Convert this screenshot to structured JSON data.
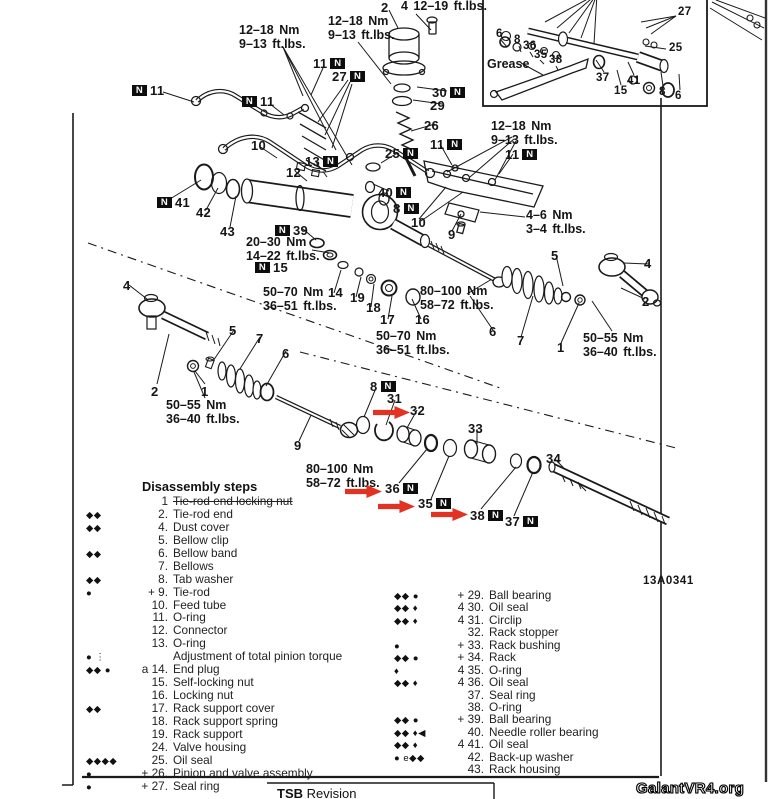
{
  "page": {
    "diagram_code": "13A0341",
    "watermark": "GalantVR4.org",
    "footer": {
      "bold": "TSB",
      "rest": "Revision"
    },
    "grease_label": "Grease",
    "n_badge": "N"
  },
  "diagram": {
    "torque_labels": [
      {
        "x": 239,
        "y": 24,
        "lines": [
          "12–18 Nm",
          "9–13 ft.lbs."
        ]
      },
      {
        "x": 328,
        "y": 15,
        "lines": [
          "12–18 Nm",
          "9–13 ft.lbs."
        ]
      },
      {
        "x": 401,
        "y": 0,
        "lines": [
          "4 12–19 ft.lbs."
        ]
      },
      {
        "x": 491,
        "y": 120,
        "lines": [
          "12–18 Nm",
          "9–13 ft.lbs."
        ]
      },
      {
        "x": 246,
        "y": 236,
        "lines": [
          "20–30 Nm",
          "14–22 ft.lbs."
        ]
      },
      {
        "x": 263,
        "y": 286,
        "lines": [
          "50–70 Nm",
          "36–51 ft.lbs."
        ]
      },
      {
        "x": 420,
        "y": 285,
        "lines": [
          "80–100 Nm",
          "58–72 ft.lbs."
        ]
      },
      {
        "x": 526,
        "y": 209,
        "lines": [
          "4–6 Nm",
          "3–4 ft.lbs."
        ]
      },
      {
        "x": 583,
        "y": 332,
        "lines": [
          "50–55 Nm",
          "36–40 ft.lbs."
        ]
      },
      {
        "x": 376,
        "y": 330,
        "lines": [
          "50–70 Nm",
          "36–51 ft.lbs."
        ]
      },
      {
        "x": 166,
        "y": 399,
        "lines": [
          "50–55 Nm",
          "36–40 ft.lbs."
        ]
      },
      {
        "x": 306,
        "y": 463,
        "lines": [
          "80–100 Nm",
          "58–72 ft.lbs."
        ]
      }
    ],
    "part_labels": [
      {
        "t": "2",
        "x": 381,
        "y": 0
      },
      {
        "t": "11",
        "b": "a",
        "x": 313,
        "y": 56
      },
      {
        "t": "27",
        "b": "a",
        "x": 332,
        "y": 69
      },
      {
        "t": "11",
        "b": "b",
        "x": 132,
        "y": 83
      },
      {
        "t": "11",
        "b": "b",
        "x": 242,
        "y": 94
      },
      {
        "t": "30",
        "b": "a",
        "x": 432,
        "y": 85
      },
      {
        "t": "29",
        "x": 430,
        "y": 98
      },
      {
        "t": "26",
        "x": 424,
        "y": 118
      },
      {
        "t": "11",
        "b": "a",
        "x": 430,
        "y": 137
      },
      {
        "t": "25",
        "b": "a",
        "x": 385,
        "y": 146
      },
      {
        "t": "11",
        "b": "a",
        "x": 505,
        "y": 147
      },
      {
        "t": "10",
        "x": 251,
        "y": 138
      },
      {
        "t": "13",
        "b": "a",
        "x": 305,
        "y": 154
      },
      {
        "t": "12",
        "x": 286,
        "y": 165
      },
      {
        "t": "40",
        "b": "a",
        "x": 378,
        "y": 185
      },
      {
        "t": "8",
        "b": "a",
        "x": 393,
        "y": 201
      },
      {
        "t": "10",
        "x": 411,
        "y": 215
      },
      {
        "t": "9",
        "x": 448,
        "y": 227
      },
      {
        "t": "41",
        "b": "b",
        "x": 157,
        "y": 195
      },
      {
        "t": "42",
        "x": 196,
        "y": 205
      },
      {
        "t": "43",
        "x": 220,
        "y": 224
      },
      {
        "t": "39",
        "b": "b",
        "x": 275,
        "y": 223
      },
      {
        "t": "15",
        "b": "b",
        "x": 255,
        "y": 260
      },
      {
        "t": "14",
        "x": 328,
        "y": 285
      },
      {
        "t": "19",
        "x": 350,
        "y": 290
      },
      {
        "t": "18",
        "x": 366,
        "y": 300
      },
      {
        "t": "17",
        "x": 380,
        "y": 312
      },
      {
        "t": "16",
        "x": 415,
        "y": 312
      },
      {
        "t": "5",
        "x": 551,
        "y": 248
      },
      {
        "t": "4",
        "x": 644,
        "y": 256
      },
      {
        "t": "2",
        "x": 642,
        "y": 294
      },
      {
        "t": "1",
        "x": 557,
        "y": 340
      },
      {
        "t": "7",
        "x": 517,
        "y": 333
      },
      {
        "t": "6",
        "x": 489,
        "y": 324
      },
      {
        "t": "4",
        "x": 123,
        "y": 278
      },
      {
        "t": "5",
        "x": 229,
        "y": 323
      },
      {
        "t": "7",
        "x": 256,
        "y": 331
      },
      {
        "t": "6",
        "x": 282,
        "y": 346
      },
      {
        "t": "2",
        "x": 151,
        "y": 384
      },
      {
        "t": "1",
        "x": 201,
        "y": 384
      },
      {
        "t": "9",
        "x": 294,
        "y": 438
      },
      {
        "t": "8",
        "b": "a",
        "x": 370,
        "y": 379
      },
      {
        "t": "31",
        "x": 387,
        "y": 391
      },
      {
        "t": "32",
        "x": 410,
        "y": 403
      },
      {
        "t": "33",
        "x": 468,
        "y": 421
      },
      {
        "t": "34",
        "x": 546,
        "y": 451
      },
      {
        "t": "36",
        "b": "a",
        "x": 385,
        "y": 481
      },
      {
        "t": "35",
        "b": "a",
        "x": 418,
        "y": 496
      },
      {
        "t": "38",
        "b": "a",
        "x": 470,
        "y": 508
      },
      {
        "t": "37",
        "b": "a",
        "x": 505,
        "y": 514
      },
      {
        "t": "27",
        "x": 678,
        "y": 6,
        "fs": "s"
      },
      {
        "t": "6",
        "x": 496,
        "y": 28,
        "fs": "s"
      },
      {
        "t": "8",
        "x": 514,
        "y": 34,
        "fs": "s"
      },
      {
        "t": "36",
        "x": 523,
        "y": 40,
        "fs": "s"
      },
      {
        "t": "35",
        "x": 534,
        "y": 49,
        "fs": "s"
      },
      {
        "t": "38",
        "x": 549,
        "y": 54,
        "fs": "s"
      },
      {
        "t": "25",
        "x": 669,
        "y": 42,
        "fs": "s"
      },
      {
        "t": "37",
        "x": 596,
        "y": 72,
        "fs": "s"
      },
      {
        "t": "41",
        "x": 627,
        "y": 75,
        "fs": "s"
      },
      {
        "t": "15",
        "x": 614,
        "y": 85,
        "fs": "s"
      },
      {
        "t": "8",
        "x": 659,
        "y": 86,
        "fs": "s"
      },
      {
        "t": "6",
        "x": 675,
        "y": 90,
        "fs": "s"
      }
    ],
    "red_arrows": [
      {
        "x": 373,
        "y": 406
      },
      {
        "x": 345,
        "y": 485
      },
      {
        "x": 378,
        "y": 500
      },
      {
        "x": 431,
        "y": 508
      }
    ],
    "grease_pos": {
      "x": 487,
      "y": 57
    },
    "code_pos": {
      "x": 643,
      "y": 575
    }
  },
  "steps": {
    "title": "Disassembly steps",
    "left": [
      {
        "m": "",
        "n": "1",
        "t": "Tie-rod end locking nut",
        "strike": true
      },
      {
        "m": "◆◆",
        "n": "2.",
        "t": "Tie-rod end"
      },
      {
        "m": "◆◆",
        "n": "4.",
        "t": "Dust cover"
      },
      {
        "m": "",
        "n": "5.",
        "t": "Bellow clip"
      },
      {
        "m": "◆◆",
        "n": "6.",
        "t": "Bellow band"
      },
      {
        "m": "",
        "n": "7.",
        "t": "Bellows"
      },
      {
        "m": "◆◆",
        "n": "8.",
        "t": "Tab washer"
      },
      {
        "m": "●",
        "n": "+ 9.",
        "t": "Tie-rod"
      },
      {
        "m": "",
        "n": "10.",
        "t": "Feed tube"
      },
      {
        "m": "",
        "n": "11.",
        "t": "O-ring"
      },
      {
        "m": "",
        "n": "12.",
        "t": "Connector"
      },
      {
        "m": "",
        "n": "13.",
        "t": "O-ring"
      },
      {
        "m": "● ⋮",
        "n": "",
        "t": "Adjustment of total pinion torque"
      },
      {
        "m": "◆◆ ●",
        "n": "a 14.",
        "t": "End plug"
      },
      {
        "m": "",
        "n": "15.",
        "t": "Self-locking nut"
      },
      {
        "m": "",
        "n": "16.",
        "t": "Locking nut"
      },
      {
        "m": "◆◆",
        "n": "17.",
        "t": "Rack support cover"
      },
      {
        "m": "",
        "n": "18.",
        "t": "Rack support spring"
      },
      {
        "m": "",
        "n": "19.",
        "t": "Rack support"
      },
      {
        "m": "",
        "n": "24.",
        "t": "Valve housing"
      },
      {
        "m": "◆◆◆◆",
        "n": "25.",
        "t": "Oil seal"
      },
      {
        "m": "●",
        "n": "+ 26.",
        "t": "Pinion and valve assembly"
      },
      {
        "m": "●",
        "n": "+ 27.",
        "t": "Seal ring"
      }
    ],
    "right": [
      {
        "m": "◆◆ ●",
        "n": "+ 29.",
        "t": "Ball bearing"
      },
      {
        "m": "◆◆ ♦",
        "n": "4 30.",
        "t": "Oil seal"
      },
      {
        "m": "◆◆ ♦",
        "n": "4 31.",
        "t": "Circlip"
      },
      {
        "m": "",
        "n": "32.",
        "t": "Rack stopper"
      },
      {
        "m": "●",
        "n": "+ 33.",
        "t": "Rack bushing"
      },
      {
        "m": "◆◆ ●",
        "n": "+ 34.",
        "t": "Rack"
      },
      {
        "m": "♦",
        "n": "4 35.",
        "t": "O-ring"
      },
      {
        "m": "◆◆ ♦",
        "n": "4 36.",
        "t": "Oil seal"
      },
      {
        "m": "",
        "n": "37.",
        "t": "Seal ring"
      },
      {
        "m": "",
        "n": "38.",
        "t": "O-ring"
      },
      {
        "m": "◆◆ ●",
        "n": "+ 39.",
        "t": "Ball bearing"
      },
      {
        "m": "◆◆ ♦◀",
        "n": "40.",
        "t": "Needle roller bearing"
      },
      {
        "m": "◆◆ ♦",
        "n": "4 41.",
        "t": "Oil seal"
      },
      {
        "m": "● e◆◆",
        "n": "42.",
        "t": "Back-up washer"
      },
      {
        "m": "",
        "n": "43.",
        "t": "Rack housing"
      }
    ]
  }
}
